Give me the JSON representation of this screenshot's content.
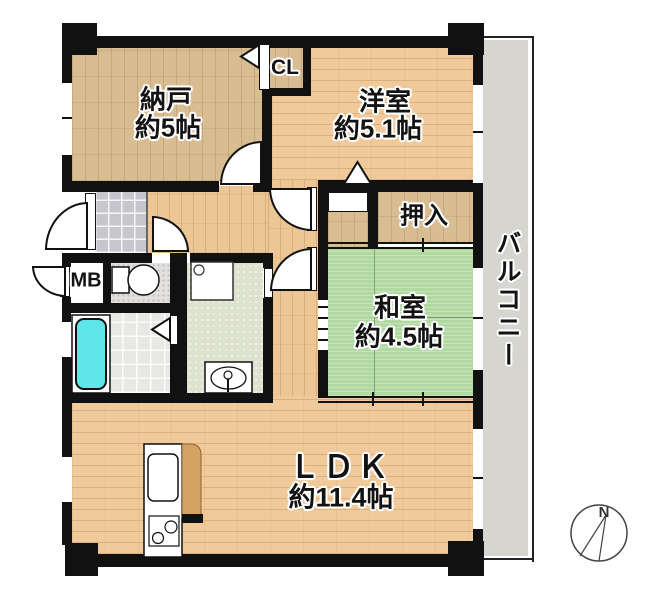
{
  "rooms": {
    "nando": {
      "name": "納戸",
      "size": "約5帖"
    },
    "closet": {
      "name": "CL"
    },
    "yoshitsu": {
      "name": "洋室",
      "size": "約5.1帖"
    },
    "oshiire": {
      "name": "押入"
    },
    "washitsu": {
      "name": "和室",
      "size": "約4.5帖"
    },
    "ldk": {
      "name": "ＬＤＫ",
      "size": "約11.4帖"
    },
    "meter_box": {
      "name": "MB"
    },
    "balcony": {
      "name": "バルコニー"
    }
  },
  "compass": {
    "north": "N"
  },
  "colors": {
    "wall": "#111111",
    "tatami_green": "#AFD9A1",
    "wood_light": "#F1CA9B",
    "wood_tan": "#D9BD92",
    "balcony_gray": "#D6D5CF",
    "bathtub_cyan": "#5FE6E9",
    "genkan_tile": "#C6C6CC"
  }
}
